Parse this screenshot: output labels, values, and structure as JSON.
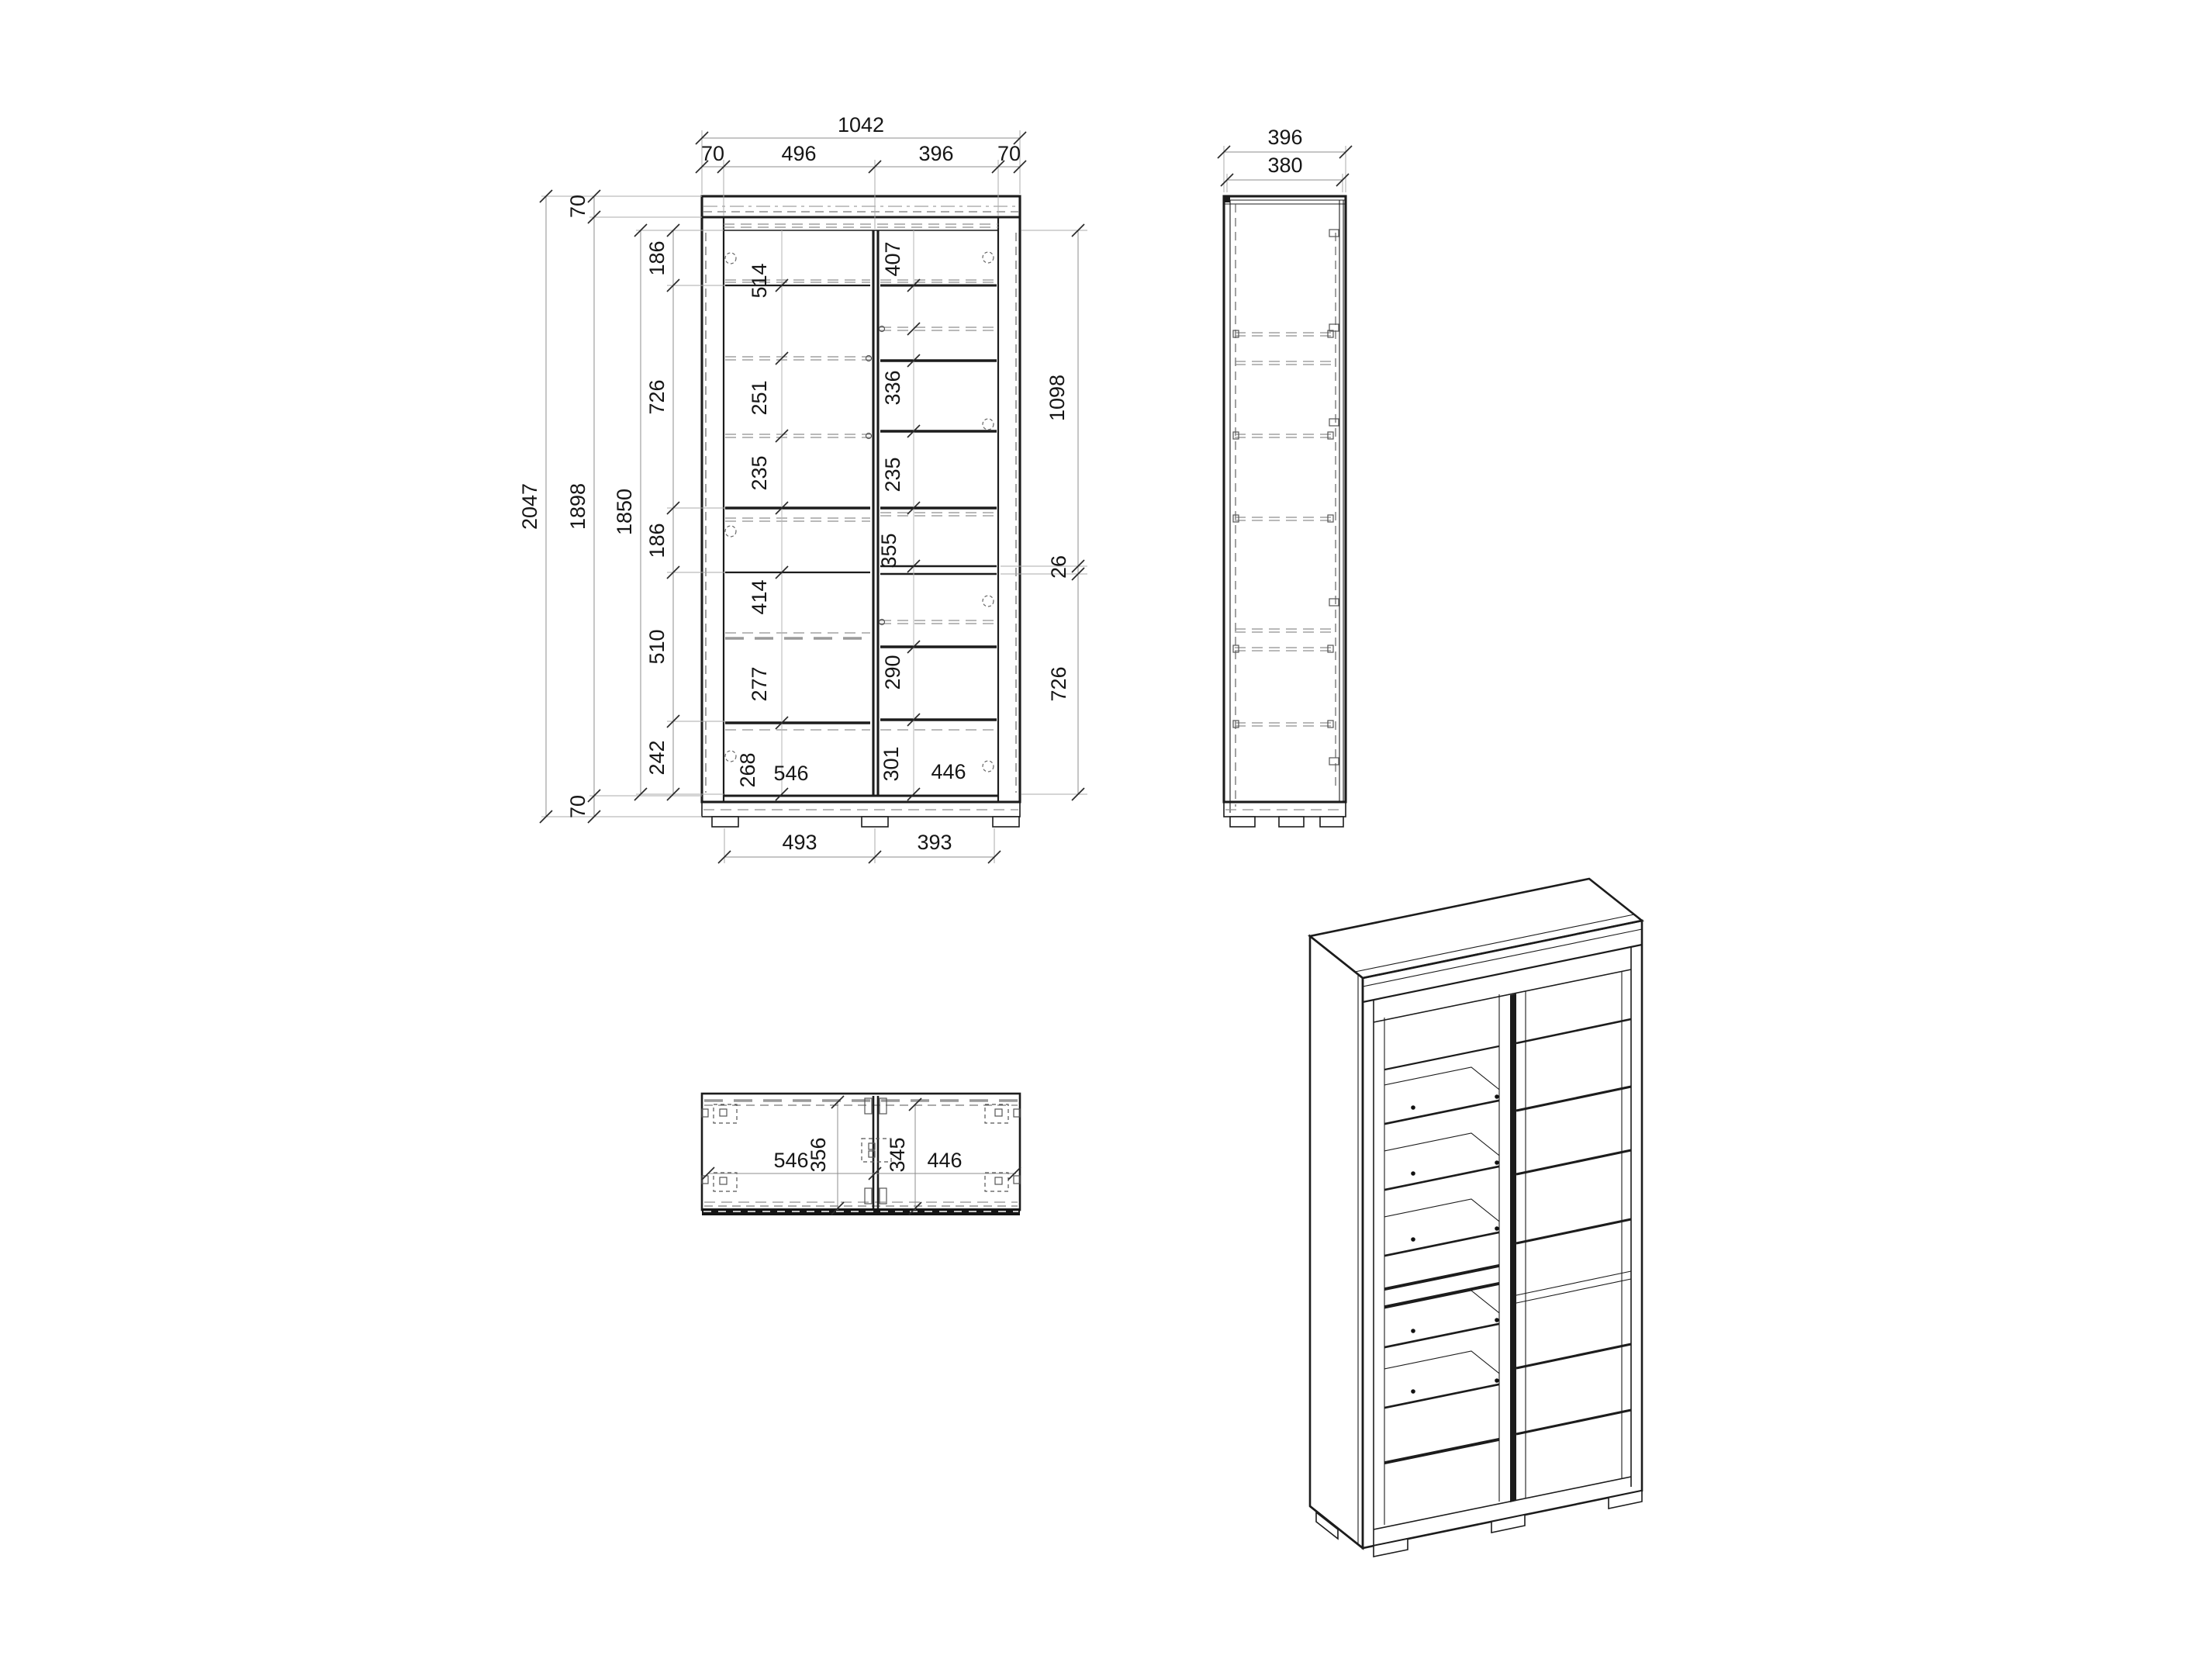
{
  "front_view": {
    "width_total": "1042",
    "width_parts": [
      "70",
      "496",
      "396",
      "70"
    ],
    "height_total": "2047",
    "height_left": [
      "70",
      "1898",
      "70"
    ],
    "height_interior": "1850",
    "left_chain": [
      "186",
      "726",
      "186",
      "510",
      "242"
    ],
    "right_chain": [
      "1098",
      "26",
      "726"
    ],
    "left_cells": [
      "514",
      "251",
      "235",
      "414",
      "277"
    ],
    "left_bottom_depth": "268",
    "left_bottom_width": "546",
    "right_cells": [
      "407",
      "336",
      "235",
      "355",
      "290"
    ],
    "right_bottom_depth": "301",
    "right_bottom_width": "446",
    "feet_dims": [
      "493",
      "393"
    ]
  },
  "side_view": {
    "depth_total": "396",
    "depth_body": "380"
  },
  "top_view": {
    "left_width": "546",
    "left_depth": "356",
    "right_depth": "345",
    "right_width": "446"
  }
}
